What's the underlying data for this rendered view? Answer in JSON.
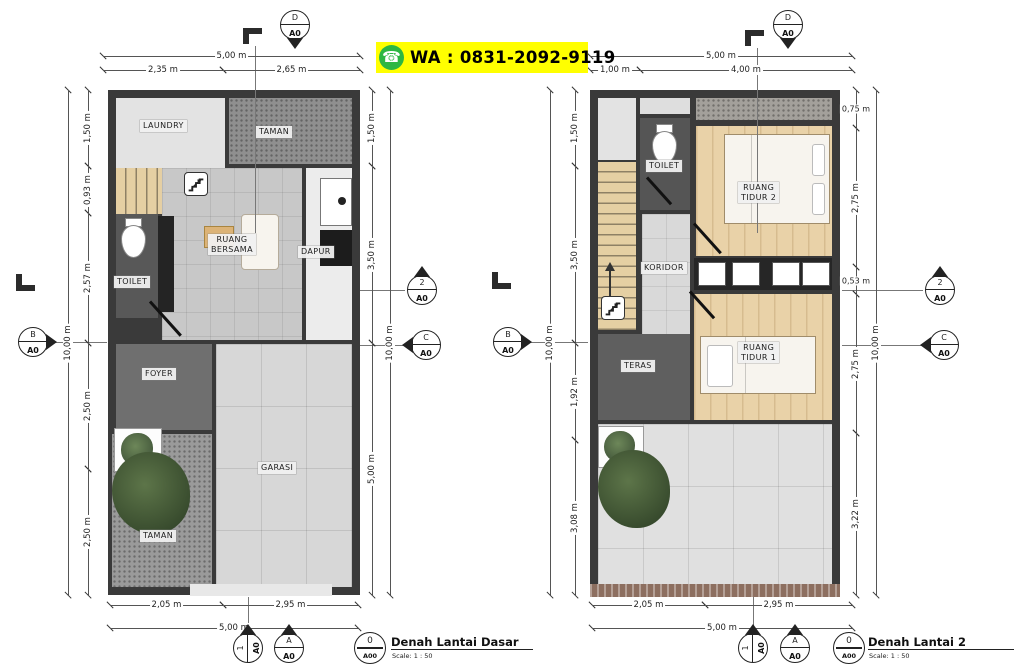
{
  "banner": {
    "icon": "☎",
    "text": "WA : 0831-2092-9119",
    "bg": "#ffff00",
    "icon_color": "#2cb742"
  },
  "plans": [
    {
      "name": "ground-floor",
      "walls": {
        "x": 108,
        "y": 90,
        "w": 252,
        "h": 505
      },
      "rooms": [
        {
          "id": "laundry",
          "x": 116,
          "y": 98,
          "w": 109,
          "h": 70,
          "fill": "#e3e3e3",
          "tex": ""
        },
        {
          "id": "taman-top",
          "x": 229,
          "y": 98,
          "w": 123,
          "h": 66,
          "fill": "#8f8f8f",
          "tex": "speckle"
        },
        {
          "id": "stairs",
          "x": 116,
          "y": 168,
          "w": 64,
          "h": 46,
          "fill": "#e5cfa3",
          "tex": "steps-v"
        },
        {
          "id": "toilet",
          "x": 116,
          "y": 214,
          "w": 42,
          "h": 104,
          "fill": "#585858",
          "tex": ""
        },
        {
          "id": "ruang-bersama",
          "x": 162,
          "y": 168,
          "w": 140,
          "h": 172,
          "fill": "#c8c8c8",
          "tex": "tile"
        },
        {
          "id": "dapur",
          "x": 306,
          "y": 168,
          "w": 46,
          "h": 172,
          "fill": "#ececec",
          "tex": ""
        },
        {
          "id": "foyer",
          "x": 116,
          "y": 344,
          "w": 96,
          "h": 86,
          "fill": "#6f6f6f",
          "tex": ""
        },
        {
          "id": "garasi",
          "x": 216,
          "y": 344,
          "w": 136,
          "h": 243,
          "fill": "#d7d7d7",
          "tex": "tile-lg"
        },
        {
          "id": "taman-bottom",
          "x": 112,
          "y": 434,
          "w": 100,
          "h": 153,
          "fill": "#9a9a9a",
          "tex": "speckle"
        }
      ],
      "labels": [
        {
          "t": "LAUNDRY",
          "x": 140,
          "y": 120
        },
        {
          "t": "TAMAN",
          "x": 256,
          "y": 126
        },
        {
          "t": "RUANG\nBERSAMA",
          "x": 208,
          "y": 234
        },
        {
          "t": "DAPUR",
          "x": 298,
          "y": 246
        },
        {
          "t": "TOILET",
          "x": 114,
          "y": 276
        },
        {
          "t": "FOYER",
          "x": 142,
          "y": 368
        },
        {
          "t": "GARASI",
          "x": 258,
          "y": 462
        },
        {
          "t": "TAMAN",
          "x": 140,
          "y": 530
        }
      ],
      "fixtures": [
        {
          "type": "rect",
          "x": 158,
          "y": 216,
          "w": 16,
          "h": 96,
          "fill": "#242424"
        },
        {
          "type": "stairs-icon",
          "x": 184,
          "y": 172,
          "w": 24,
          "h": 24
        },
        {
          "type": "wc",
          "x": 121,
          "y": 218,
          "w": 25,
          "h": 40
        },
        {
          "type": "table",
          "x": 204,
          "y": 226,
          "w": 30,
          "h": 22
        },
        {
          "type": "sofa",
          "x": 241,
          "y": 214,
          "w": 38,
          "h": 56
        },
        {
          "type": "appliance",
          "x": 320,
          "y": 178,
          "w": 32,
          "h": 48
        },
        {
          "type": "rect",
          "x": 320,
          "y": 230,
          "w": 32,
          "h": 36,
          "fill": "#1c1c1c"
        },
        {
          "type": "door",
          "x": 150,
          "y": 300,
          "len": 46,
          "rot": 48
        },
        {
          "type": "planter",
          "x": 114,
          "y": 428,
          "w": 48,
          "h": 44
        },
        {
          "type": "tree",
          "x": 112,
          "y": 452,
          "w": 78,
          "h": 82
        },
        {
          "type": "rect",
          "x": 190,
          "y": 584,
          "w": 142,
          "h": 12,
          "fill": "#e8e8e8"
        }
      ],
      "dims": [
        {
          "o": "h",
          "v": "5,00 m",
          "x": 103,
          "y": 56,
          "len": 257
        },
        {
          "o": "h",
          "v": "2,35 m",
          "x": 103,
          "y": 70,
          "len": 120
        },
        {
          "o": "h",
          "v": "2,65 m",
          "x": 223,
          "y": 70,
          "len": 137
        },
        {
          "o": "h",
          "v": "2,05 m",
          "x": 110,
          "y": 605,
          "len": 113
        },
        {
          "o": "h",
          "v": "2,95 m",
          "x": 223,
          "y": 605,
          "len": 135
        },
        {
          "o": "h",
          "v": "5,00 m",
          "x": 110,
          "y": 628,
          "len": 248
        },
        {
          "o": "v",
          "v": "10,00 m",
          "x": 68,
          "y": 90,
          "len": 505
        },
        {
          "o": "v",
          "v": "1,50 m",
          "x": 88,
          "y": 90,
          "len": 76
        },
        {
          "o": "v",
          "v": "0,93 m",
          "x": 88,
          "y": 166,
          "len": 47
        },
        {
          "o": "v",
          "v": "2,57 m",
          "x": 88,
          "y": 213,
          "len": 130
        },
        {
          "o": "v",
          "v": "2,50 m",
          "x": 88,
          "y": 343,
          "len": 126
        },
        {
          "o": "v",
          "v": "2,50 m",
          "x": 88,
          "y": 469,
          "len": 126
        },
        {
          "o": "v",
          "v": "1,50 m",
          "x": 372,
          "y": 90,
          "len": 76
        },
        {
          "o": "v",
          "v": "3,50 m",
          "x": 372,
          "y": 166,
          "len": 177
        },
        {
          "o": "v",
          "v": "5,00 m",
          "x": 372,
          "y": 343,
          "len": 252
        },
        {
          "o": "v",
          "v": "10,00 m",
          "x": 390,
          "y": 90,
          "len": 505
        }
      ],
      "markers": [
        {
          "top": "D",
          "bot": "A0",
          "x": 295,
          "y": 25,
          "dir": "down",
          "rot": 0
        },
        {
          "top": "B",
          "bot": "A0",
          "x": 33,
          "y": 342,
          "dir": "right",
          "rot": 0
        },
        {
          "top": "2",
          "bot": "A0",
          "x": 422,
          "y": 290,
          "dir": "up",
          "rot": 0
        },
        {
          "top": "C",
          "bot": "A0",
          "x": 426,
          "y": 345,
          "dir": "left",
          "rot": 0
        },
        {
          "top": "1",
          "bot": "A0",
          "x": 248,
          "y": 648,
          "dir": "right",
          "rot": 1
        },
        {
          "top": "A",
          "bot": "A0",
          "x": 289,
          "y": 648,
          "dir": "up",
          "rot": 0
        }
      ],
      "lines": [
        {
          "x1": 255,
          "y1": 46,
          "x2": 255,
          "y2": 233
        },
        {
          "x1": 50,
          "y1": 342,
          "x2": 107,
          "y2": 342
        },
        {
          "x1": 360,
          "y1": 290,
          "x2": 405,
          "y2": 290
        },
        {
          "x1": 360,
          "y1": 345,
          "x2": 409,
          "y2": 345
        },
        {
          "x1": 248,
          "y1": 597,
          "x2": 248,
          "y2": 631
        }
      ],
      "lsyms": [
        {
          "x": 243,
          "y": 28,
          "kind": "gamma"
        },
        {
          "x": 16,
          "y": 274,
          "kind": "l"
        }
      ],
      "title": {
        "num": "0",
        "sheet": "A00",
        "text": "Denah Lantai Dasar",
        "scale": "Scale: 1 : 50",
        "cx": 369,
        "cy": 647,
        "tx": 391,
        "rx": 533
      }
    },
    {
      "name": "second-floor",
      "walls": {
        "x": 590,
        "y": 90,
        "w": 250,
        "h": 505
      },
      "rooms": [
        {
          "id": "void-left",
          "x": 598,
          "y": 98,
          "w": 38,
          "h": 62,
          "fill": "#e3e3e3",
          "tex": ""
        },
        {
          "id": "void-mid",
          "x": 640,
          "y": 98,
          "w": 50,
          "h": 16,
          "fill": "#dedede",
          "tex": ""
        },
        {
          "id": "roof",
          "x": 696,
          "y": 98,
          "w": 136,
          "h": 22,
          "fill": "#a3a09b",
          "tex": "speckle"
        },
        {
          "id": "toilet",
          "x": 640,
          "y": 118,
          "w": 50,
          "h": 92,
          "fill": "#555555",
          "tex": ""
        },
        {
          "id": "ruang-tidur-2",
          "x": 696,
          "y": 126,
          "w": 136,
          "h": 130,
          "fill": "#e9d2a8",
          "tex": "wood"
        },
        {
          "id": "stairs",
          "x": 598,
          "y": 162,
          "w": 38,
          "h": 168,
          "fill": "#e5cfa3",
          "tex": "steps-h"
        },
        {
          "id": "koridor",
          "x": 642,
          "y": 214,
          "w": 48,
          "h": 134,
          "fill": "#d9d9d9",
          "tex": "tile"
        },
        {
          "id": "teras",
          "x": 598,
          "y": 334,
          "w": 92,
          "h": 86,
          "fill": "#5f5f5f",
          "tex": ""
        },
        {
          "id": "ruang-tidur-1",
          "x": 694,
          "y": 294,
          "w": 138,
          "h": 126,
          "fill": "#e9d2a8",
          "tex": "wood"
        },
        {
          "id": "balcony",
          "x": 598,
          "y": 424,
          "w": 234,
          "h": 161,
          "fill": "#e0e0e0",
          "tex": "tile-lg"
        }
      ],
      "labels": [
        {
          "t": "TOILET",
          "x": 646,
          "y": 160
        },
        {
          "t": "RUANG\nTIDUR 2",
          "x": 738,
          "y": 182
        },
        {
          "t": "KORIDOR",
          "x": 641,
          "y": 262
        },
        {
          "t": "TERAS",
          "x": 621,
          "y": 360
        },
        {
          "t": "RUANG\nTIDUR 1",
          "x": 738,
          "y": 342
        }
      ],
      "fixtures": [
        {
          "type": "stairs-icon",
          "x": 601,
          "y": 296,
          "w": 24,
          "h": 24
        },
        {
          "type": "arrow",
          "x": 604,
          "y": 262,
          "w": 12,
          "h": 46
        },
        {
          "type": "wc",
          "x": 652,
          "y": 124,
          "w": 25,
          "h": 40
        },
        {
          "type": "bed2",
          "x": 724,
          "y": 134,
          "w": 106,
          "h": 90
        },
        {
          "type": "wardrobe",
          "x": 694,
          "y": 258,
          "w": 138,
          "h": 32
        },
        {
          "type": "bed1",
          "x": 700,
          "y": 336,
          "w": 116,
          "h": 58
        },
        {
          "type": "door",
          "x": 694,
          "y": 222,
          "len": 40,
          "rot": 48
        },
        {
          "type": "door",
          "x": 647,
          "y": 176,
          "len": 36,
          "rot": 48
        },
        {
          "type": "door",
          "x": 690,
          "y": 290,
          "len": 36,
          "rot": 48
        },
        {
          "type": "planter",
          "x": 598,
          "y": 426,
          "w": 46,
          "h": 42
        },
        {
          "type": "tree",
          "x": 598,
          "y": 450,
          "w": 72,
          "h": 78
        },
        {
          "type": "hatch",
          "x": 590,
          "y": 584,
          "w": 250,
          "h": 13
        }
      ],
      "dims": [
        {
          "o": "h",
          "v": "5,00 m",
          "x": 590,
          "y": 56,
          "len": 262
        },
        {
          "o": "h",
          "v": "1,00 m",
          "x": 590,
          "y": 70,
          "len": 50
        },
        {
          "o": "h",
          "v": "4,00 m",
          "x": 640,
          "y": 70,
          "len": 212
        },
        {
          "o": "h",
          "v": "2,05 m",
          "x": 592,
          "y": 605,
          "len": 113
        },
        {
          "o": "h",
          "v": "2,95 m",
          "x": 705,
          "y": 605,
          "len": 147
        },
        {
          "o": "h",
          "v": "5,00 m",
          "x": 592,
          "y": 628,
          "len": 260
        },
        {
          "o": "v",
          "v": "10,00 m",
          "x": 550,
          "y": 90,
          "len": 505
        },
        {
          "o": "v",
          "v": "1,50 m",
          "x": 575,
          "y": 90,
          "len": 76
        },
        {
          "o": "v",
          "v": "3,50 m",
          "x": 575,
          "y": 166,
          "len": 177
        },
        {
          "o": "v",
          "v": "1,92 m",
          "x": 575,
          "y": 343,
          "len": 97
        },
        {
          "o": "v",
          "v": "3,08 m",
          "x": 575,
          "y": 440,
          "len": 155
        },
        {
          "o": "v",
          "v": "0,75 m",
          "x": 856,
          "y": 90,
          "len": 38,
          "horiz": true
        },
        {
          "o": "v",
          "v": "2,75 m",
          "x": 856,
          "y": 128,
          "len": 139
        },
        {
          "o": "v",
          "v": "0,53 m",
          "x": 856,
          "y": 267,
          "len": 27,
          "horiz": true
        },
        {
          "o": "v",
          "v": "2,75 m",
          "x": 856,
          "y": 294,
          "len": 139
        },
        {
          "o": "v",
          "v": "3,22 m",
          "x": 856,
          "y": 433,
          "len": 162
        },
        {
          "o": "v",
          "v": "10,00 m",
          "x": 876,
          "y": 90,
          "len": 505
        }
      ],
      "markers": [
        {
          "top": "D",
          "bot": "A0",
          "x": 788,
          "y": 25,
          "dir": "down",
          "rot": 0
        },
        {
          "top": "B",
          "bot": "A0",
          "x": 508,
          "y": 342,
          "dir": "right",
          "rot": 0
        },
        {
          "top": "2",
          "bot": "A0",
          "x": 940,
          "y": 290,
          "dir": "up",
          "rot": 0
        },
        {
          "top": "C",
          "bot": "A0",
          "x": 944,
          "y": 345,
          "dir": "left",
          "rot": 0
        },
        {
          "top": "1",
          "bot": "A0",
          "x": 753,
          "y": 648,
          "dir": "right",
          "rot": 1
        },
        {
          "top": "A",
          "bot": "A0",
          "x": 795,
          "y": 648,
          "dir": "up",
          "rot": 0
        }
      ],
      "lines": [
        {
          "x1": 757,
          "y1": 48,
          "x2": 757,
          "y2": 233
        },
        {
          "x1": 525,
          "y1": 342,
          "x2": 588,
          "y2": 342
        },
        {
          "x1": 842,
          "y1": 290,
          "x2": 923,
          "y2": 290
        },
        {
          "x1": 842,
          "y1": 345,
          "x2": 927,
          "y2": 345
        },
        {
          "x1": 753,
          "y1": 597,
          "x2": 753,
          "y2": 631
        }
      ],
      "lsyms": [
        {
          "x": 745,
          "y": 30,
          "kind": "gamma"
        },
        {
          "x": 492,
          "y": 272,
          "kind": "l"
        }
      ],
      "title": {
        "num": "0",
        "sheet": "A00",
        "text": "Denah Lantai 2",
        "scale": "Scale: 1 : 50",
        "cx": 848,
        "cy": 647,
        "tx": 868,
        "rx": 1014
      }
    }
  ]
}
